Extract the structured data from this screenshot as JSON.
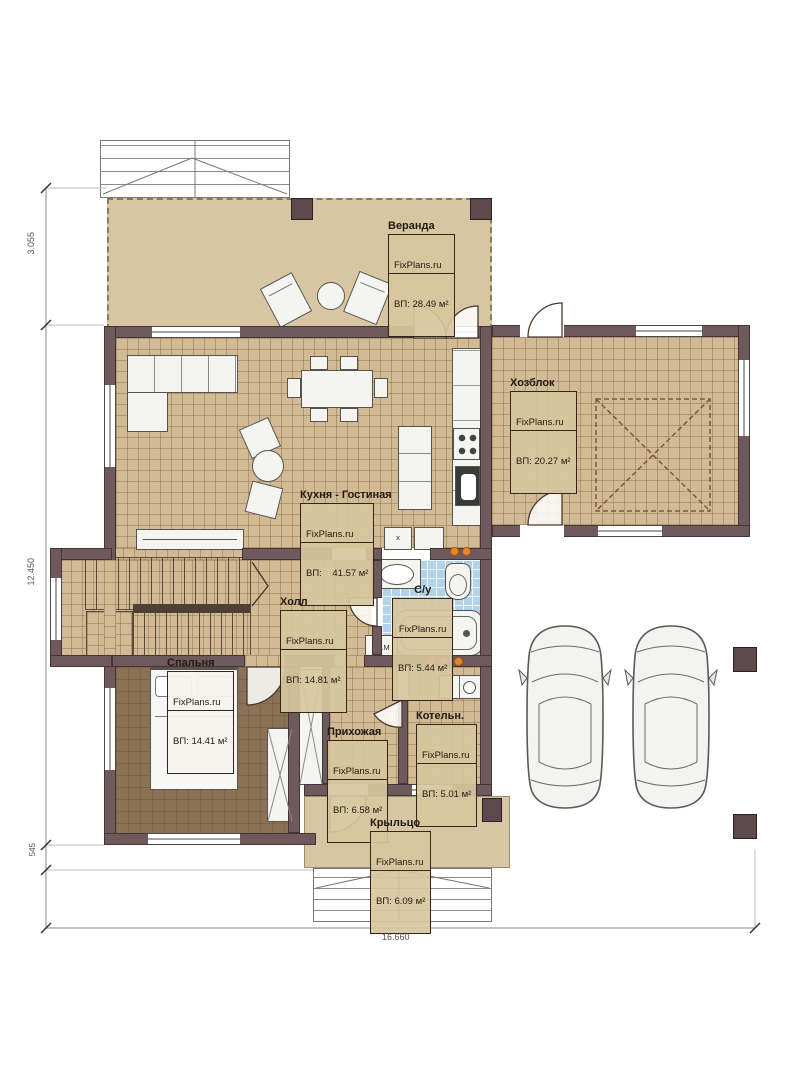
{
  "brand": "FixPlans.ru",
  "rooms": {
    "veranda": {
      "name": "Веранда",
      "area": "ВП: 28.49 м²"
    },
    "hozblok": {
      "name": "Хозблок",
      "area": "ВП: 20.27 м²"
    },
    "kitchen_living": {
      "name": "Кухня - Гостиная",
      "area": "ВП:    41.57 м²"
    },
    "hall": {
      "name": "Холл",
      "area": "ВП: 14.81 м²"
    },
    "bathroom": {
      "name": "С/у",
      "area": "ВП: 5.44 м²"
    },
    "bedroom": {
      "name": "Спальня",
      "area": "ВП: 14.41 м²"
    },
    "entry_hall": {
      "name": "Прихожая",
      "area": "ВП: 6.58 м²"
    },
    "boiler": {
      "name": "Котельн.",
      "area": "ВП: 5.01 м²"
    },
    "porch": {
      "name": "Крыльцо",
      "area": "ВП: 6.09 м²"
    }
  },
  "annotations": {
    "washing_machine": "Ст.М",
    "vent_box": "x"
  },
  "dimensions": {
    "left_top": "3.055",
    "left_middle": "12.450",
    "left_bottom": "545",
    "bottom": "16.660"
  },
  "colors": {
    "wall": "#6e5a5c",
    "tile_floor": "#d2bb94",
    "bedroom_floor": "#8b7254",
    "veranda_floor": "#d8c6a3",
    "bathroom_floor": "#b0d2ea",
    "accent_orange": "#e8862c"
  }
}
